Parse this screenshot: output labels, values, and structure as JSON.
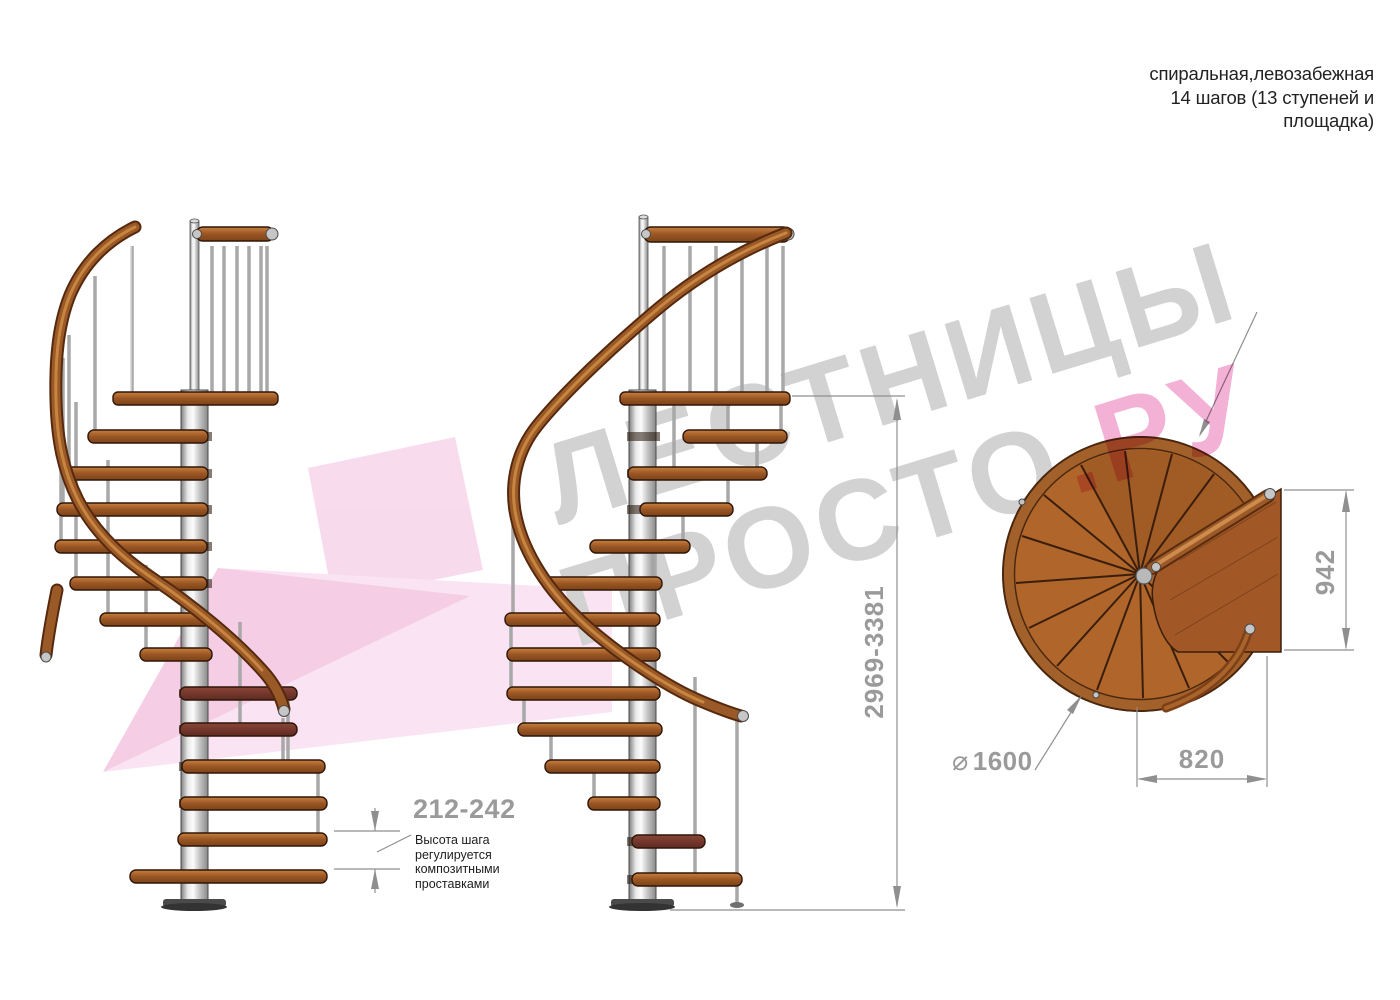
{
  "title_block": {
    "line1": "спиральная,левозабежная",
    "line2": "14 шагов (13 ступеней и",
    "line3": "площадка)"
  },
  "watermark": {
    "brand_line1": "ЛЕСТНИЦЫ",
    "brand_line2_gray": "ПРОСТО",
    "brand_line2_pink": ".РУ"
  },
  "dimensions": {
    "total_height": "2969-3381",
    "step_height_range": "212-242",
    "plan_depth": "942",
    "plan_width": "820",
    "diameter_symbol": "⌀",
    "diameter_value": "1600"
  },
  "annotation": {
    "lines": [
      "Высота шага",
      "регулируется",
      "композитными",
      "проставками"
    ]
  },
  "colors": {
    "wood": "#b0662a",
    "wood_dark": "#7c4318",
    "pole_gray": "#c9c9c9",
    "dimension_gray": "#9a9a9a",
    "watermark_gray": "#d2d2d2",
    "watermark_pink": "#f3b1d6"
  }
}
